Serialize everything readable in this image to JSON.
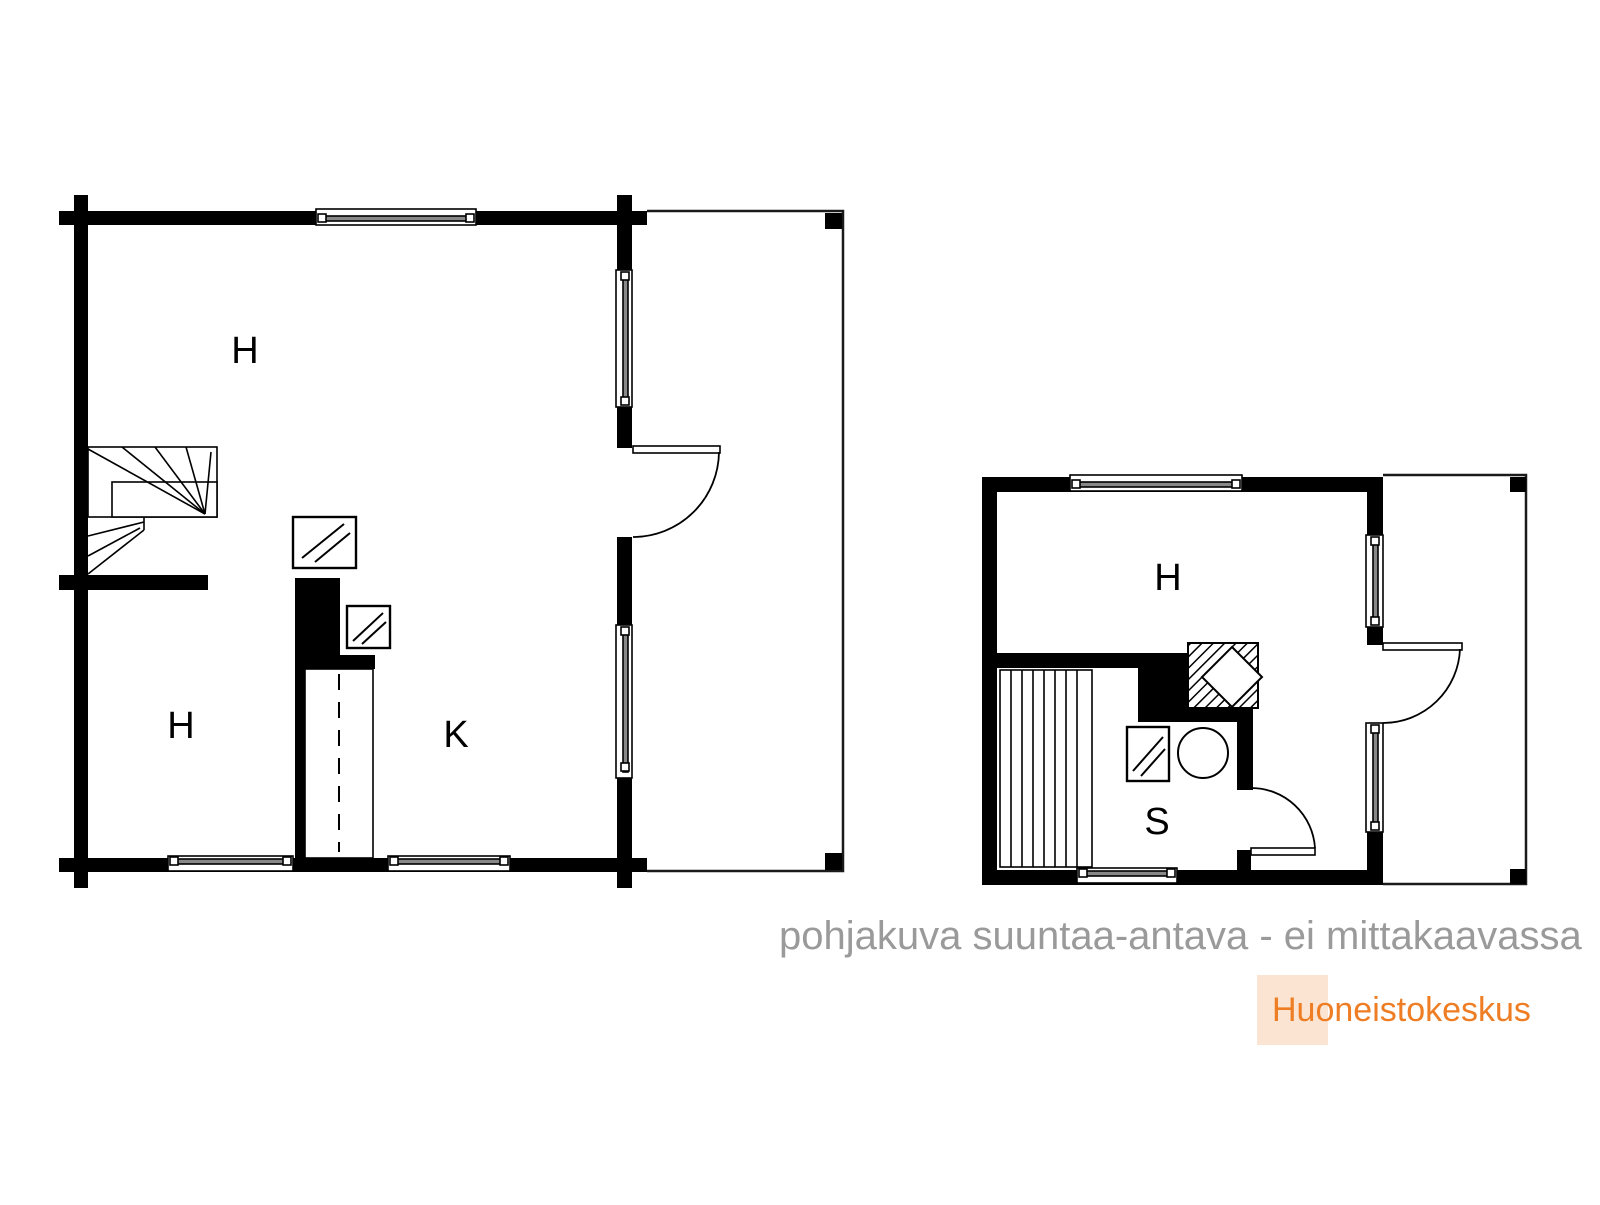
{
  "caption": {
    "text": "pohjakuva suuntaa-antava - ei mittakaavassa",
    "color": "#9a9a9a"
  },
  "logo": {
    "text": "Huoneistokeskus",
    "color": "#ee7d23",
    "box_color": "#fbe5d2"
  },
  "colors": {
    "walls": "#000000",
    "background": "#ffffff"
  },
  "plans": {
    "left": {
      "rooms": [
        {
          "label": "H"
        },
        {
          "label": "H"
        },
        {
          "label": "K"
        }
      ]
    },
    "right": {
      "rooms": [
        {
          "label": "H"
        },
        {
          "label": "S"
        }
      ]
    }
  }
}
